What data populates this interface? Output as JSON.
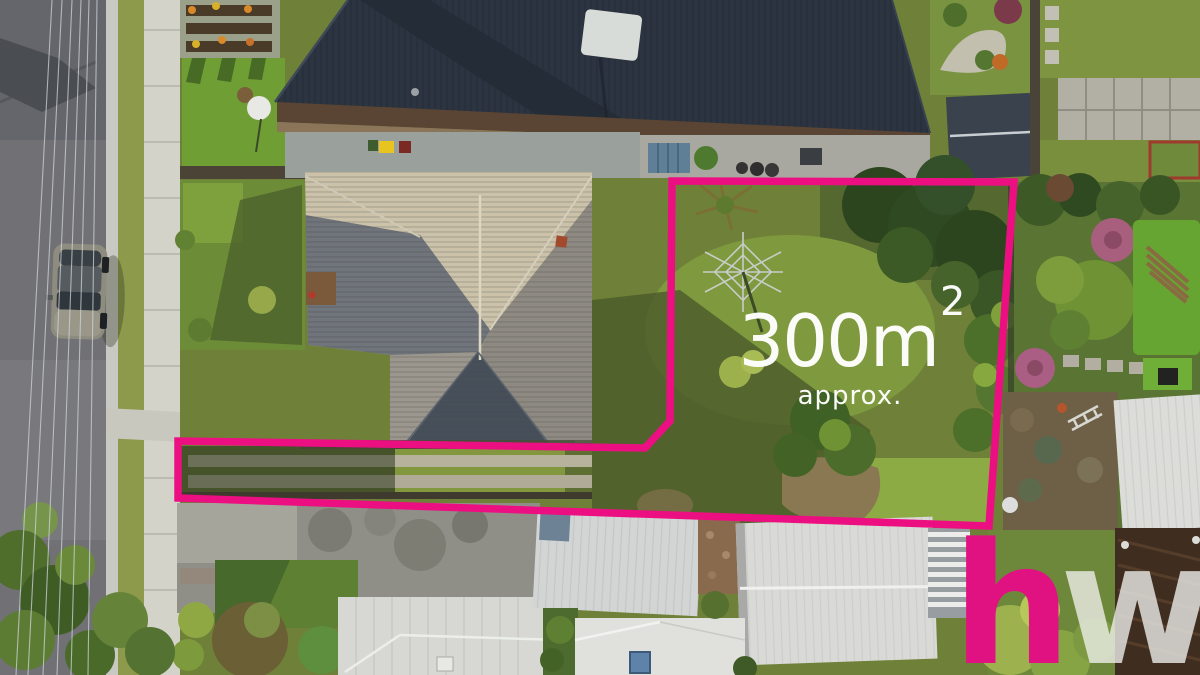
{
  "overlay": {
    "area_value": "300m",
    "area_exponent": "2",
    "area_qualifier": "approx.",
    "text_color": "#ffffff"
  },
  "branding": {
    "letter_1": "h",
    "letter_2": "w",
    "letter_1_color": "#e01281",
    "letter_2_color": "rgba(240,240,237,0.78)"
  },
  "boundary": {
    "color": "#ec0f81",
    "stroke_width": "7.5",
    "points": "672,181 1014,182 989,526 178,498 178,441 645,448 670,421"
  },
  "scene": {
    "description": "aerial drone view of suburban battleaxe block outlined in pink",
    "grass_base": "#6f8138",
    "road_gray": "#717175",
    "dark_roof": "#2b3440",
    "tile_roof_lit": "#cbc2a9",
    "tile_roof_shadow": "#47505a",
    "white_roof": "#d9dad6"
  }
}
